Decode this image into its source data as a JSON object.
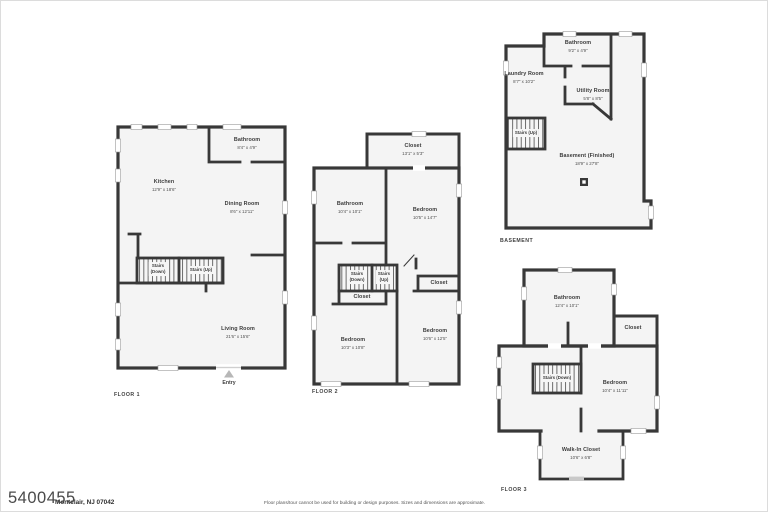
{
  "sheet": {
    "property_id": "5400455",
    "location": "Montclair, NJ 07042",
    "disclaimer": "Floor plans/tour cannot be used for building or design purposes. Sizes and dimensions are approximate."
  },
  "floor1": {
    "tag": "FLOOR 1",
    "entry": "Entry",
    "rooms": {
      "bathroom": {
        "name": "Bathroom",
        "dims": "8'4\" x 4'9\""
      },
      "kitchen": {
        "name": "Kitchen",
        "dims": "12'9\" x 18'6\""
      },
      "dining_room": {
        "name": "Dining Room",
        "dims": "8'6\" x 12'11\""
      },
      "stairs_down": {
        "name": "Stairs\n(Down)"
      },
      "stairs_up": {
        "name": "Stairs (Up)"
      },
      "living_room": {
        "name": "Living Room",
        "dims": "21'6\" x 15'6\""
      }
    }
  },
  "floor2": {
    "tag": "FLOOR 2",
    "rooms": {
      "closet_top": {
        "name": "Closet",
        "dims": "13'1\" x 5'3\""
      },
      "bathroom": {
        "name": "Bathroom",
        "dims": "10'4\" x 10'1\""
      },
      "bedroom_right": {
        "name": "Bedroom",
        "dims": "10'5\" x 14'7\""
      },
      "stairs_down": {
        "name": "Stairs\n(Down)"
      },
      "stairs_up": {
        "name": "Stairs\n(Up)"
      },
      "closet_mid": {
        "name": "Closet"
      },
      "closet_right": {
        "name": "Closet"
      },
      "bedroom_bottom_left": {
        "name": "Bedroom",
        "dims": "10'3\" x 10'8\""
      },
      "bedroom_bottom_right": {
        "name": "Bedroom",
        "dims": "10'6\" x 12'5\""
      }
    }
  },
  "basement": {
    "tag": "BASEMENT",
    "rooms": {
      "bathroom": {
        "name": "Bathroom",
        "dims": "9'2\" x 4'9\""
      },
      "laundry_room": {
        "name": "Laundry Room",
        "dims": "8'7\" x 10'2\""
      },
      "utility_room": {
        "name": "Utility Room",
        "dims": "5'8\" x 8'5\""
      },
      "stairs_up": {
        "name": "Stairs (Up)"
      },
      "basement_finished": {
        "name": "Basement (Finished)",
        "dims": "18'9\" x 27'8\""
      }
    }
  },
  "floor3": {
    "tag": "FLOOR 3",
    "rooms": {
      "bathroom": {
        "name": "Bathroom",
        "dims": "12'4\" x 10'1\""
      },
      "closet": {
        "name": "Closet"
      },
      "stairs_down": {
        "name": "Stairs (Down)"
      },
      "bedroom": {
        "name": "Bedroom",
        "dims": "10'4\" x 11'11\""
      },
      "walk_in_closet": {
        "name": "Walk-In Closet",
        "dims": "10'6\" x 6'8\""
      }
    }
  }
}
